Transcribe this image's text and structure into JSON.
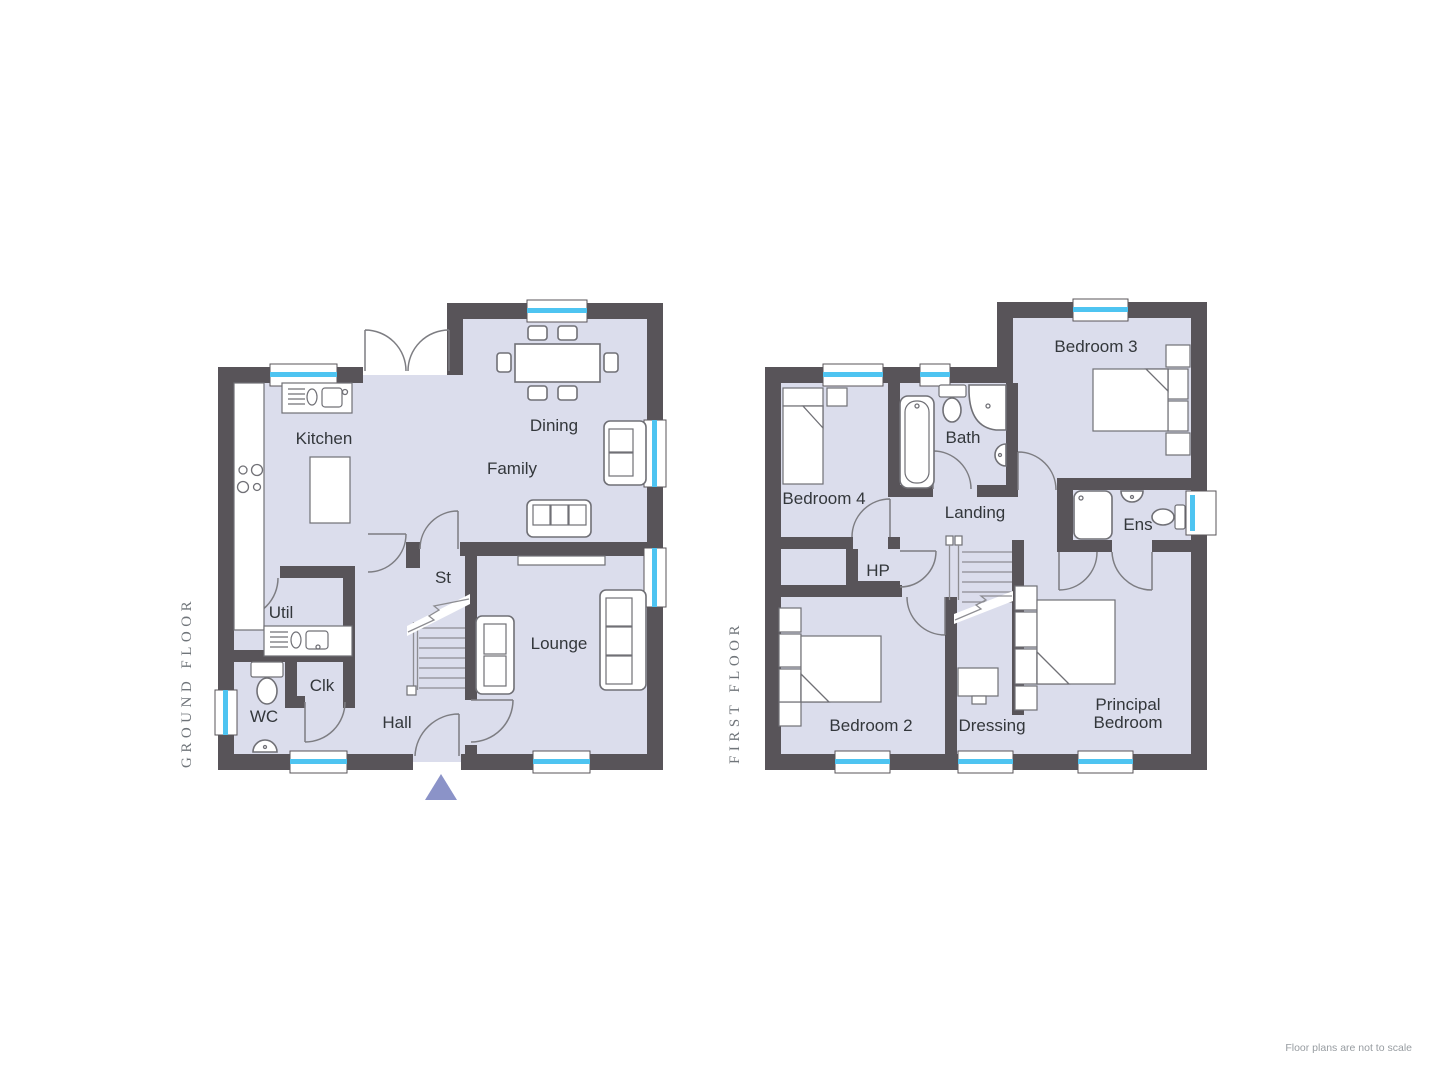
{
  "note": "Floor plans are not to scale",
  "colors": {
    "wall": "#585459",
    "floor": "#dbddec",
    "window_blue": "#4ec4f1",
    "furniture_stroke": "#707076",
    "door_stroke": "#7d7d82",
    "stair_line": "#8d8d92",
    "label_text": "#33373b",
    "floor_title_text": "#70757a",
    "note_text": "#979ca1",
    "entrance_arrow": "#8b93c8"
  },
  "ground_floor": {
    "title": "GROUND FLOOR",
    "labels": {
      "kitchen": "Kitchen",
      "dining": "Dining",
      "family": "Family",
      "util": "Util",
      "st": "St",
      "lounge": "Lounge",
      "wc": "WC",
      "clk": "Clk",
      "hall": "Hall"
    }
  },
  "first_floor": {
    "title": "FIRST FLOOR",
    "labels": {
      "bedroom3": "Bedroom 3",
      "bath": "Bath",
      "bedroom4": "Bedroom 4",
      "landing": "Landing",
      "ens": "Ens",
      "hp": "HP",
      "bedroom2": "Bedroom 2",
      "dressing": "Dressing",
      "principal_line1": "Principal",
      "principal_line2": "Bedroom"
    }
  }
}
